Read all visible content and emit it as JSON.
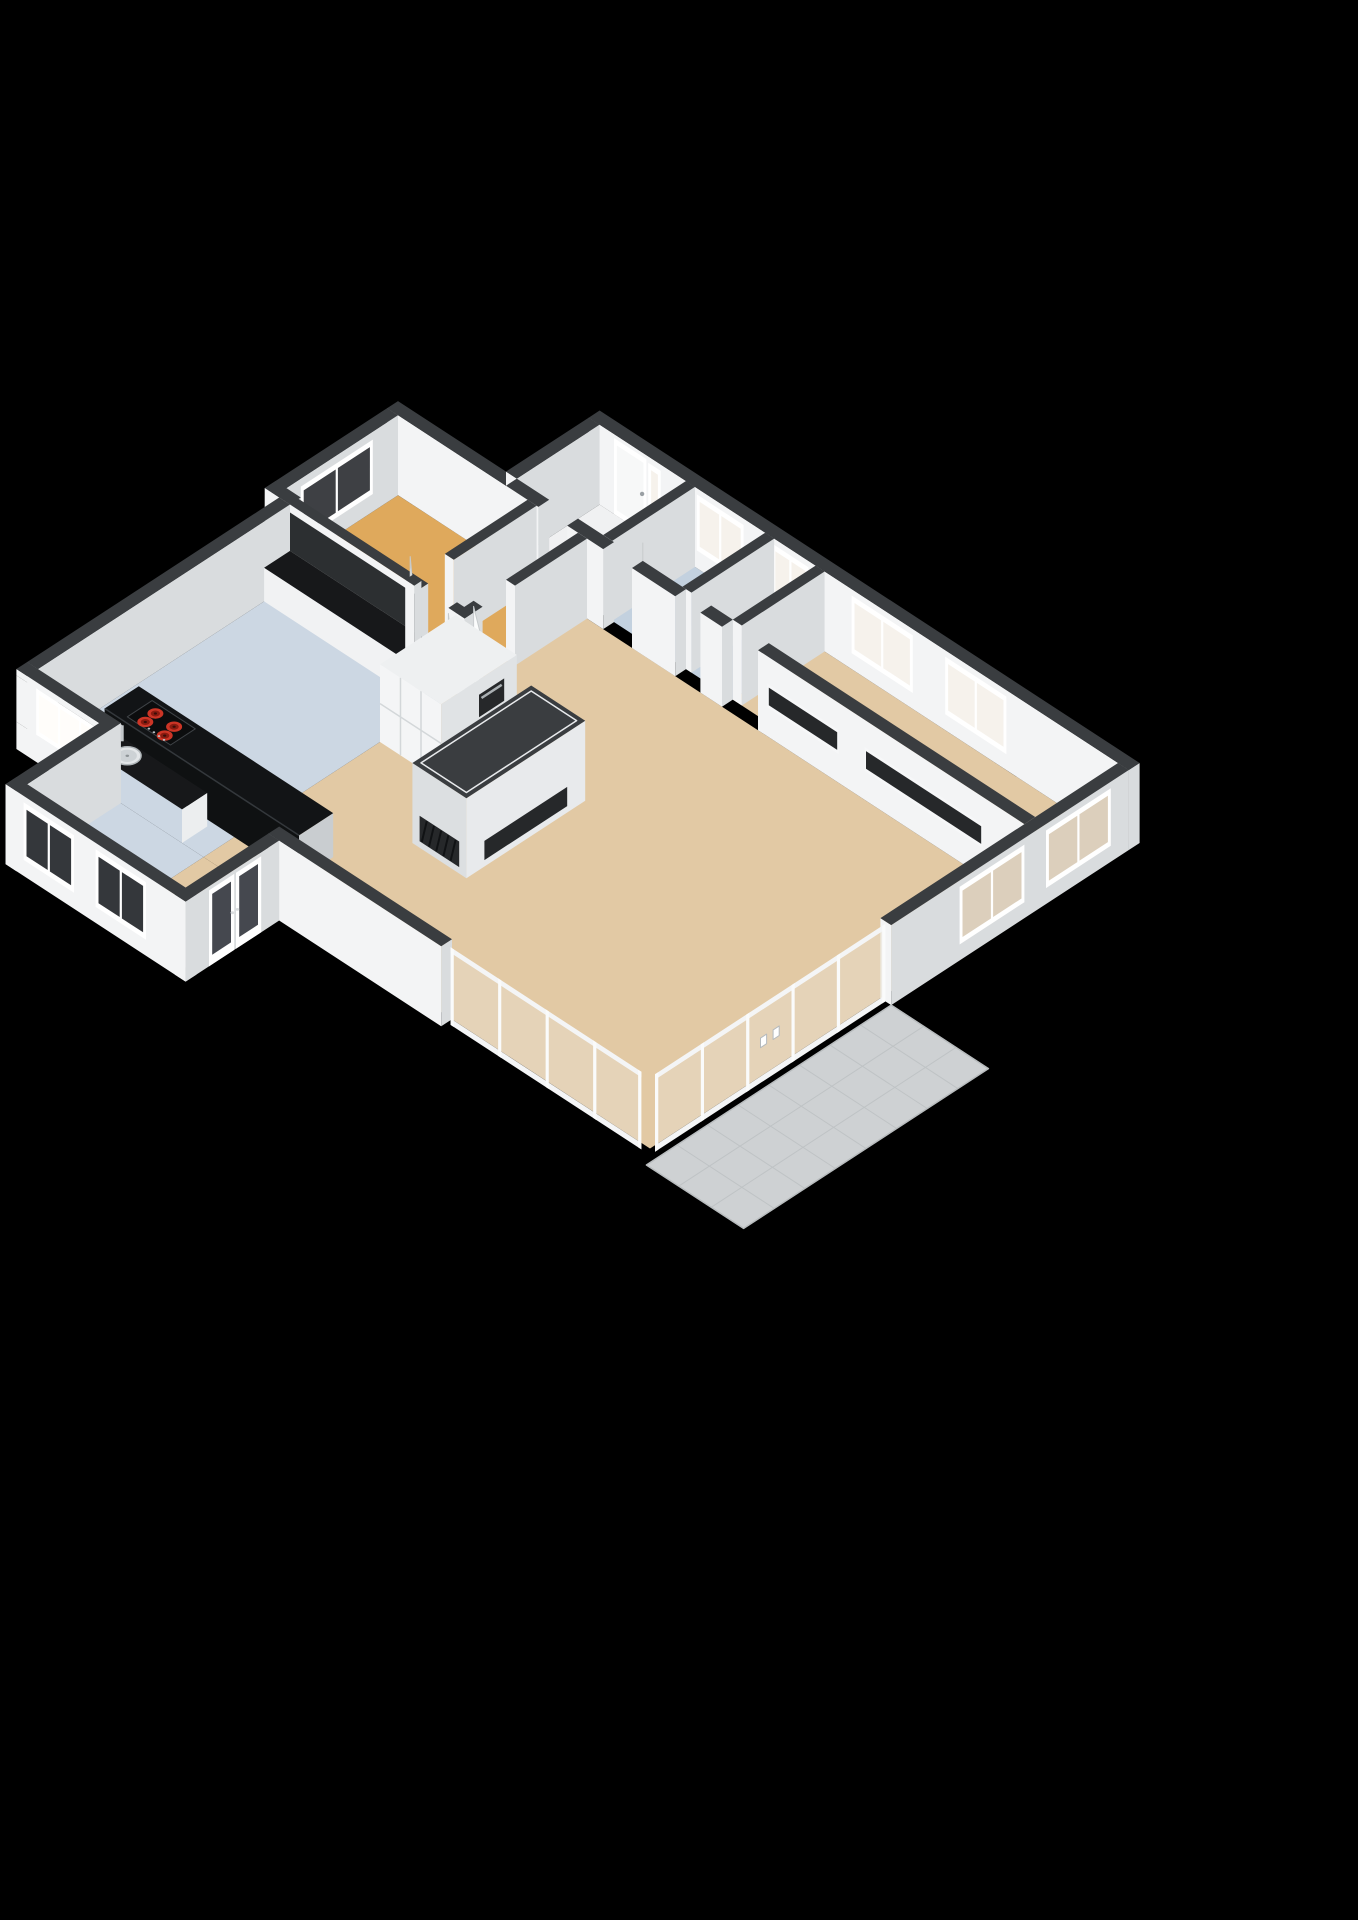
{
  "scene": {
    "type": "3d-floor-plan",
    "view": "isometric-cutaway",
    "description": "3D rendered cutaway floor plan of an apartment with kitchen, living room, bedroom, bathroom and terrace",
    "background": "#000000"
  },
  "colors": {
    "background": "#000000",
    "wall_top": "#3a3d40",
    "wall_face_light": "#f3f4f5",
    "wall_face_shade": "#d9dcde",
    "floor_living": "#e2c9a4",
    "floor_bedroom": "#dfa95c",
    "floor_kitchen": "#ccd7e3",
    "floor_bath": "#c3d1df",
    "floor_hall": "#f0f1f2",
    "terrace_tile": "#ced1d3",
    "terrace_line": "#bfc3c5",
    "counter_black": "#17181a",
    "island_front": "#0f1112",
    "island_top": "#121416",
    "cooktop_red": "#cc3526",
    "cooktop_red_dark": "#8a1b10",
    "glass_pane": "#e9dfd0",
    "window_dark": "#23262a",
    "cabinet_gray": "#e2e5e7",
    "niche_dark": "#26282a",
    "splash_dark": "#2c2f31",
    "door_white": "#fbfcfc"
  },
  "rooms": [
    {
      "id": "entry",
      "name": "Entry Hall",
      "floor_color": "floor_hall",
      "rect": [
        3.6,
        0.0,
        6.0,
        2.3
      ]
    },
    {
      "id": "bathroom",
      "name": "Bathroom",
      "floor_color": "floor_bath",
      "rect": [
        6.0,
        0.0,
        8.2,
        2.3
      ]
    },
    {
      "id": "toilet",
      "name": "Toilet",
      "floor_color": "floor_bath",
      "rect": [
        8.2,
        0.0,
        9.6,
        2.3
      ]
    },
    {
      "id": "study",
      "name": "Study / Bedroom 2",
      "floor_color": "floor_living",
      "rect": [
        9.6,
        0.0,
        18.0,
        2.3
      ]
    },
    {
      "id": "bedroom",
      "name": "Bedroom",
      "floor_color": "floor_bedroom",
      "rect": [
        0.6,
        2.6,
        4.2,
        5.76
      ]
    },
    {
      "id": "corridor",
      "name": "Corridor",
      "floor_color": "floor_bedroom",
      "rect": [
        4.2,
        2.6,
        5.6,
        6.0
      ]
    },
    {
      "id": "living-room",
      "name": "Living Room",
      "floor_color": "floor_living",
      "rect": [
        5.6,
        2.6,
        18.0,
        13.0
      ]
    },
    {
      "id": "kitchen",
      "name": "Kitchen",
      "floor_color": "floor_kitchen",
      "rect": [
        1.0,
        6.0,
        5.6,
        13.0
      ]
    },
    {
      "id": "kitchen-extension",
      "name": "Kitchen Extension",
      "floor_color": "floor_kitchen",
      "rect": [
        3.0,
        13.0,
        5.6,
        15.6
      ]
    },
    {
      "id": "dining-nook",
      "name": "Dining Nook",
      "floor_color": "floor_living",
      "rect": [
        5.6,
        13.0,
        7.7,
        15.6
      ]
    },
    {
      "id": "terrace",
      "name": "Terrace",
      "floor_color": "terrace_tile",
      "rect": [
        18.3,
        6.6,
        21.0,
        13.4
      ]
    }
  ],
  "features": {
    "kitchen_island": {
      "counter": "black",
      "cooktop": {
        "type": "ceramic",
        "burners": 4
      }
    },
    "kitchen_counter": {
      "sinks": 2,
      "faucet": true,
      "window_above": true
    },
    "tall_cabinets": {
      "built_in_oven": true
    },
    "room_divider": {
      "niches": 2,
      "open_top": true
    },
    "glass_wall": {
      "panes": 5,
      "doors": 2,
      "handles": 2,
      "corner_panes": 4
    },
    "extension_wing": {
      "windows": 2,
      "french_doors": true
    },
    "terrace": {
      "material": "tile",
      "grid": true
    },
    "windows": {
      "top_wall": 4,
      "corner": 2,
      "bedroom": 1,
      "interior_slots": 2
    },
    "doors": {
      "entry": 1,
      "interior_open_leaves": 4
    }
  }
}
